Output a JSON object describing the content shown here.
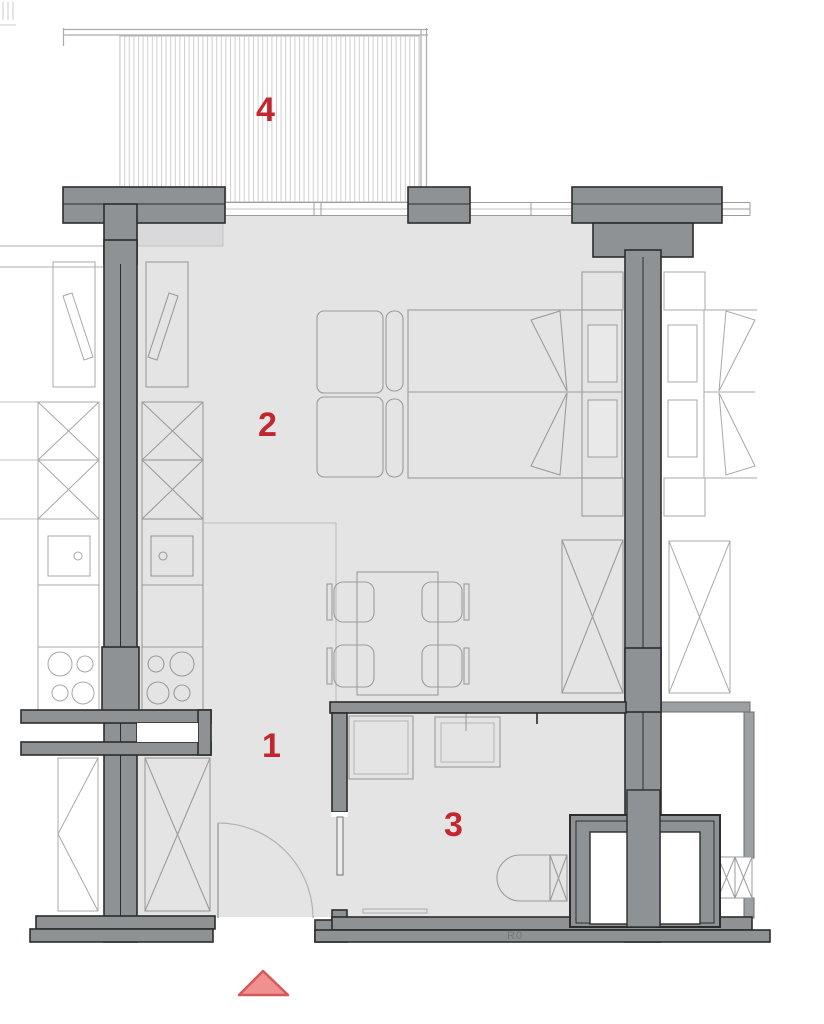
{
  "labels": {
    "balcony": "4",
    "living_room": "2",
    "hall": "1",
    "bathroom": "3",
    "shaft": "R0"
  },
  "colors": {
    "wall_fill": "#8f9295",
    "wall_outline": "#2b2d2e",
    "light_wall_fill": "#9da0a3",
    "floor_fill": "#e4e4e5",
    "floor_light_band": "#d9d9db",
    "furniture_line": "#9b9b9b",
    "neighbor_line": "#a8a8a8",
    "balcony_hatch": "#cfcfcf",
    "window_frame": "#9c9c9c",
    "label_red": "#c2262f",
    "marker_fill": "#f0918f",
    "marker_stroke": "#d4595b",
    "shaft_text": "#747779"
  }
}
